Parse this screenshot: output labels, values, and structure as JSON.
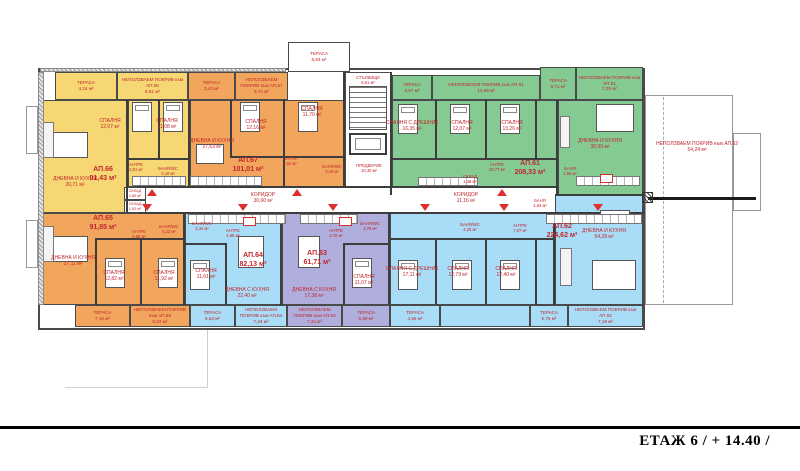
{
  "meta": {
    "floor_label": "ЕТАЖ 6 / + 14.40 /"
  },
  "palette": {
    "yellow": "#f6d774",
    "orange": "#f2a55c",
    "green": "#85ca92",
    "blue": "#a9dcf6",
    "lavender": "#afaedc",
    "white": "#ffffff",
    "wall": "#3d3d3d",
    "label_red": "#c1272d",
    "arrow_red": "#e02f2f"
  },
  "zones": [
    {
      "id": "terrace-ap66",
      "x": 55,
      "y": 72,
      "w": 62,
      "h": 28,
      "fill": "yellow",
      "label": "ТЕРАСА",
      "area": "4,24 м²"
    },
    {
      "id": "roof-ap66",
      "x": 117,
      "y": 72,
      "w": 71,
      "h": 28,
      "fill": "yellow",
      "label": "НЕПОЛЗВАЕМ ПОКРИВ към АП.66",
      "area": "8,91 м²"
    },
    {
      "id": "terrace-ap67",
      "x": 188,
      "y": 72,
      "w": 47,
      "h": 28,
      "fill": "orange",
      "label": "ТЕРАСА",
      "area": "3,43 м²"
    },
    {
      "id": "roof-ap67",
      "x": 235,
      "y": 72,
      "w": 53,
      "h": 28,
      "fill": "orange",
      "label": "НЕПОЛЗВАЕМ ПОКРИВ към АП.67",
      "area": "3,74 м²"
    },
    {
      "id": "terrace-stair",
      "x": 288,
      "y": 42,
      "w": 62,
      "h": 30,
      "fill": "white",
      "label": "ТЕРАСА",
      "area": "8,83 м²"
    },
    {
      "id": "terrace-ap61-left",
      "x": 392,
      "y": 75,
      "w": 40,
      "h": 25,
      "fill": "green",
      "label": "ТЕРАСА",
      "area": "3,07 м²"
    },
    {
      "id": "roof-ap61",
      "x": 432,
      "y": 75,
      "w": 108,
      "h": 25,
      "fill": "green",
      "label": "НЕПОЛЗВАЕМ ПОКРИВ към АП.61",
      "area": "14,68 м²"
    },
    {
      "id": "terrace-ap61-right",
      "x": 540,
      "y": 67,
      "w": 36,
      "h": 33,
      "fill": "green",
      "label": "ТЕРАСА",
      "area": "5,71 м²"
    },
    {
      "id": "roof-ap61-right",
      "x": 576,
      "y": 67,
      "w": 67,
      "h": 33,
      "fill": "green",
      "label": "НЕПОЛЗВАЕМ ПОКРИВ към АП.61",
      "area": "7,39 м²"
    },
    {
      "id": "ap66-main",
      "x": 40,
      "y": 100,
      "w": 88,
      "h": 113,
      "fill": "yellow"
    },
    {
      "id": "ap66-bedrooms",
      "x": 128,
      "y": 100,
      "w": 62,
      "h": 87,
      "fill": "yellow"
    },
    {
      "id": "ap67",
      "x": 190,
      "y": 100,
      "w": 155,
      "h": 87,
      "fill": "orange"
    },
    {
      "id": "stairwell",
      "x": 345,
      "y": 72,
      "w": 47,
      "h": 115,
      "fill": "white"
    },
    {
      "id": "ap61-main",
      "x": 392,
      "y": 100,
      "w": 166,
      "h": 87,
      "fill": "green"
    },
    {
      "id": "ap61-living",
      "x": 558,
      "y": 100,
      "w": 85,
      "h": 95,
      "fill": "green"
    },
    {
      "id": "corridor",
      "x": 138,
      "y": 187,
      "w": 420,
      "h": 26,
      "fill": "white"
    },
    {
      "id": "skl-1",
      "x": 124,
      "y": 187,
      "w": 22,
      "h": 13,
      "fill": "white",
      "label": "СКЛАД",
      "area": "1,80 м²",
      "tiny": true
    },
    {
      "id": "skl-2",
      "x": 124,
      "y": 200,
      "w": 22,
      "h": 13,
      "fill": "white",
      "label": "СКЛАД",
      "area": "1,52 м²",
      "tiny": true
    },
    {
      "id": "ap65",
      "x": 40,
      "y": 213,
      "w": 145,
      "h": 92,
      "fill": "orange"
    },
    {
      "id": "ap64",
      "x": 185,
      "y": 213,
      "w": 97,
      "h": 92,
      "fill": "blue"
    },
    {
      "id": "ap63",
      "x": 282,
      "y": 213,
      "w": 108,
      "h": 92,
      "fill": "lavender"
    },
    {
      "id": "ap62-bedrooms",
      "x": 390,
      "y": 213,
      "w": 165,
      "h": 92,
      "fill": "blue"
    },
    {
      "id": "ap62-living",
      "x": 555,
      "y": 195,
      "w": 88,
      "h": 110,
      "fill": "blue"
    },
    {
      "id": "strip-terrace-ap65",
      "x": 75,
      "y": 305,
      "w": 55,
      "h": 22,
      "fill": "orange",
      "label": "ТЕРАСА",
      "area": "7,16 м²"
    },
    {
      "id": "strip-roof-ap65",
      "x": 130,
      "y": 305,
      "w": 60,
      "h": 22,
      "fill": "orange",
      "label": "НЕПОЛЗВАЕМ ПОКРИВ към АП.65",
      "area": "5,63 м²"
    },
    {
      "id": "strip-terrace-ap64",
      "x": 190,
      "y": 305,
      "w": 45,
      "h": 22,
      "fill": "blue",
      "label": "ТЕРАСА",
      "area": "5,63 м²"
    },
    {
      "id": "strip-roof-ap64",
      "x": 235,
      "y": 305,
      "w": 52,
      "h": 22,
      "fill": "blue",
      "label": "НЕПОЛЗВАЕМ ПОКРИВ към АП.64",
      "area": "7,34 м²"
    },
    {
      "id": "strip-roof-ap63",
      "x": 287,
      "y": 305,
      "w": 55,
      "h": 22,
      "fill": "lavender",
      "label": "НЕПОЛЗВАЕМ ПОКРИВ към АП.63",
      "area": "7,34 м²"
    },
    {
      "id": "strip-terrace-ap63",
      "x": 342,
      "y": 305,
      "w": 48,
      "h": 22,
      "fill": "lavender",
      "label": "ТЕРАСА",
      "area": "5,90 м²"
    },
    {
      "id": "strip-terrace-ap62a",
      "x": 390,
      "y": 305,
      "w": 50,
      "h": 22,
      "fill": "blue",
      "label": "ТЕРАСА",
      "area": "4,56 м²"
    },
    {
      "id": "strip-ap62-plain",
      "x": 440,
      "y": 305,
      "w": 90,
      "h": 22,
      "fill": "blue"
    },
    {
      "id": "strip-terrace-ap62b",
      "x": 530,
      "y": 305,
      "w": 38,
      "h": 22,
      "fill": "blue",
      "label": "ТЕРАСА",
      "area": "5,75 м²"
    },
    {
      "id": "strip-roof-ap62",
      "x": 568,
      "y": 305,
      "w": 75,
      "h": 22,
      "fill": "blue",
      "label": "НЕПОЛЗВАЕМ ПОКРИВ към АП.62",
      "area": "7,19 м²"
    }
  ],
  "apartments": [
    {
      "label": "АП.66",
      "area": "91,43 м²",
      "x": 103,
      "y": 166
    },
    {
      "label": "АП.65",
      "area": "91,85 м²",
      "x": 103,
      "y": 215
    },
    {
      "label": "АП.67",
      "area": "101,01 м²",
      "x": 248,
      "y": 157
    },
    {
      "label": "АП.61",
      "area": "208,33 м²",
      "x": 530,
      "y": 160
    },
    {
      "label": "АП.62",
      "area": "224,62 м²",
      "x": 562,
      "y": 223
    },
    {
      "label": "АП.64",
      "area": "82,13 м²",
      "x": 253,
      "y": 252
    },
    {
      "label": "АП.63",
      "area": "61,71 м²",
      "x": 317,
      "y": 250
    }
  ],
  "rooms": [
    {
      "n": "СПАЛНЯ",
      "a": "12,07 м²",
      "x": 110,
      "y": 118
    },
    {
      "n": "СПАЛНЯ",
      "a": "11,08 м²",
      "x": 167,
      "y": 118
    },
    {
      "n": "ДНЕВНА И КУХНЯ",
      "a": "20,71 м²",
      "x": 75,
      "y": 176
    },
    {
      "n": "АНТРЕ",
      "a": "3,81 м²",
      "x": 136,
      "y": 162,
      "tiny": true
    },
    {
      "n": "БАНЯ/WC",
      "a": "2,18 м²",
      "x": 168,
      "y": 166,
      "tiny": true
    },
    {
      "n": "ДНЕВНА И КУХНЯ",
      "a": "27,63 м²",
      "x": 212,
      "y": 138
    },
    {
      "n": "СПАЛНЯ",
      "a": "12,16 м²",
      "x": 256,
      "y": 119
    },
    {
      "n": "СПАЛНЯ",
      "a": "11,70 м²",
      "x": 312,
      "y": 106
    },
    {
      "n": "АНТРЕ",
      "a": "3,62 м²",
      "x": 290,
      "y": 156,
      "tiny": true
    },
    {
      "n": "БАНЯ/WC",
      "a": "2,19 м²",
      "x": 332,
      "y": 164,
      "tiny": true
    },
    {
      "n": "СТЪЛБИЩЕ",
      "a": "8,61 м²",
      "x": 368,
      "y": 75,
      "tiny": true
    },
    {
      "n": "ПРЕДВЕРИЕ",
      "a": "10,30 м²",
      "x": 369,
      "y": 163,
      "tiny": true
    },
    {
      "n": "КОРИДОР",
      "a": "30,60 м²",
      "x": 263,
      "y": 192
    },
    {
      "n": "КОРИДОР",
      "a": "11,16 м²",
      "x": 466,
      "y": 192
    },
    {
      "n": "СПАЛНЯ С ДРЕШНИК",
      "a": "16,35 м²",
      "x": 412,
      "y": 120
    },
    {
      "n": "СПАЛНЯ",
      "a": "12,07 м²",
      "x": 462,
      "y": 120
    },
    {
      "n": "СПАЛНЯ",
      "a": "13,26 м²",
      "x": 512,
      "y": 120
    },
    {
      "n": "ДНЕВНА И КУХНЯ",
      "a": "30,90 м²",
      "x": 600,
      "y": 138
    },
    {
      "n": "АНТРЕ",
      "a": "20,77 м²",
      "x": 497,
      "y": 162,
      "tiny": true
    },
    {
      "n": "СКЛАД",
      "a": "1,48 м²",
      "x": 470,
      "y": 174,
      "tiny": true
    },
    {
      "n": "БАНЯ",
      "a": "4,50 м²",
      "x": 570,
      "y": 166,
      "tiny": true
    },
    {
      "n": "БАНЯ",
      "a": "4,63 м²",
      "x": 540,
      "y": 198,
      "tiny": true
    },
    {
      "n": "СПАЛНЯ С ДРЕШНИК",
      "a": "17,11 м²",
      "x": 412,
      "y": 266
    },
    {
      "n": "СПАЛНЯ",
      "a": "12,79 м²",
      "x": 458,
      "y": 266
    },
    {
      "n": "СПАЛНЯ",
      "a": "12,40 м²",
      "x": 506,
      "y": 266
    },
    {
      "n": "АНТРЕ",
      "a": "7,07 м²",
      "x": 520,
      "y": 223,
      "tiny": true
    },
    {
      "n": "БАНЯ/WC",
      "a": "4,20 м²",
      "x": 470,
      "y": 222,
      "tiny": true
    },
    {
      "n": "ДНЕВНА И КУХНЯ",
      "a": "54,28 м²",
      "x": 604,
      "y": 228
    },
    {
      "n": "БАНЯ/WC",
      "a": "3,34 м²",
      "x": 202,
      "y": 221,
      "tiny": true
    },
    {
      "n": "АНТРЕ",
      "a": "4,95 м²",
      "x": 233,
      "y": 228,
      "tiny": true
    },
    {
      "n": "СПАЛНЯ",
      "a": "11,61 м²",
      "x": 206,
      "y": 268
    },
    {
      "n": "ДНЕВНА С КУХНЯ",
      "a": "22,40 м²",
      "x": 247,
      "y": 287
    },
    {
      "n": "БАНЯ/WC",
      "a": "3,79 м²",
      "x": 370,
      "y": 221,
      "tiny": true
    },
    {
      "n": "АНТРЕ",
      "a": "3,78 м²",
      "x": 336,
      "y": 228,
      "tiny": true
    },
    {
      "n": "СПАЛНЯ",
      "a": "11,07 м²",
      "x": 364,
      "y": 274
    },
    {
      "n": "ДНЕВНА С КУХНЯ",
      "a": "17,38 м²",
      "x": 314,
      "y": 287
    },
    {
      "n": "ДНЕВНА И КУХНЯ",
      "a": "27,11 м²",
      "x": 73,
      "y": 255
    },
    {
      "n": "АНТРЕ",
      "a": "5,85 м²",
      "x": 139,
      "y": 229,
      "tiny": true
    },
    {
      "n": "БАНЯ/WC",
      "a": "5,23 м²",
      "x": 169,
      "y": 224,
      "tiny": true
    },
    {
      "n": "СПАЛНЯ",
      "a": "12,82 м²",
      "x": 114,
      "y": 270
    },
    {
      "n": "СПАЛНЯ",
      "a": "11,92 м²",
      "x": 164,
      "y": 270
    }
  ],
  "annex": {
    "label": "НЕПОЛЗВАЕМ ПОКРИВ към АП.62",
    "area": "54,24 м²",
    "x": 697,
    "y": 141,
    "rects": [
      [
        645,
        95,
        88,
        210
      ],
      [
        733,
        133,
        28,
        78
      ]
    ],
    "dash": [
      663,
      97,
      206
    ],
    "cut": [
      648,
      197,
      108
    ],
    "hatchbox": [
      642,
      192,
      11,
      11
    ]
  },
  "walls": [
    [
      126,
      100,
      2,
      113
    ],
    [
      188,
      100,
      2,
      87
    ],
    [
      158,
      100,
      2,
      58
    ],
    [
      128,
      158,
      62,
      2
    ],
    [
      230,
      100,
      2,
      58
    ],
    [
      283,
      100,
      2,
      87
    ],
    [
      230,
      156,
      113,
      2
    ],
    [
      343,
      72,
      2,
      115
    ],
    [
      390,
      72,
      2,
      123
    ],
    [
      435,
      100,
      2,
      60
    ],
    [
      485,
      100,
      2,
      60
    ],
    [
      535,
      100,
      2,
      60
    ],
    [
      556,
      100,
      2,
      95
    ],
    [
      392,
      158,
      164,
      2
    ],
    [
      138,
      186,
      420,
      2
    ],
    [
      138,
      212,
      507,
      2
    ],
    [
      555,
      194,
      90,
      2
    ],
    [
      183,
      213,
      2,
      92
    ],
    [
      280,
      213,
      2,
      92
    ],
    [
      388,
      213,
      2,
      92
    ],
    [
      553,
      213,
      2,
      92
    ],
    [
      95,
      240,
      2,
      65
    ],
    [
      140,
      240,
      2,
      65
    ],
    [
      95,
      238,
      90,
      2
    ],
    [
      225,
      245,
      2,
      60
    ],
    [
      185,
      243,
      42,
      2
    ],
    [
      343,
      245,
      2,
      60
    ],
    [
      343,
      243,
      47,
      2
    ],
    [
      435,
      240,
      2,
      65
    ],
    [
      485,
      240,
      2,
      65
    ],
    [
      535,
      240,
      2,
      65
    ],
    [
      390,
      238,
      165,
      2
    ]
  ],
  "markers": {
    "up_x": [
      147,
      292,
      497
    ],
    "up_y": 189,
    "down_x": [
      142,
      238,
      328,
      420,
      499,
      593
    ],
    "down_y": 204
  },
  "badges": [
    [
      243,
      217,
      13,
      9
    ],
    [
      339,
      217,
      13,
      9
    ],
    [
      600,
      174,
      13,
      9
    ]
  ],
  "furniture": {
    "beds": [
      [
        132,
        102
      ],
      [
        163,
        102
      ],
      [
        240,
        102
      ],
      [
        298,
        102
      ],
      [
        398,
        104
      ],
      [
        450,
        104
      ],
      [
        500,
        104
      ],
      [
        105,
        258
      ],
      [
        158,
        258
      ],
      [
        190,
        260
      ],
      [
        352,
        258
      ],
      [
        398,
        260
      ],
      [
        452,
        260
      ],
      [
        500,
        260
      ]
    ],
    "tables": [
      [
        52,
        132,
        36,
        26
      ],
      [
        50,
        236,
        38,
        26
      ],
      [
        196,
        144,
        28,
        20
      ],
      [
        596,
        104,
        38,
        28
      ],
      [
        592,
        260,
        44,
        30
      ],
      [
        238,
        236,
        26,
        32
      ],
      [
        298,
        236,
        22,
        32
      ],
      [
        600,
        210,
        30,
        14
      ]
    ],
    "sofas": [
      [
        42,
        122,
        12,
        36
      ],
      [
        42,
        226,
        12,
        36
      ],
      [
        560,
        116,
        10,
        32
      ],
      [
        560,
        248,
        12,
        38
      ]
    ],
    "counters": [
      [
        132,
        176,
        54,
        10
      ],
      [
        190,
        176,
        72,
        10
      ],
      [
        418,
        177,
        60,
        9
      ],
      [
        576,
        176,
        64,
        10
      ],
      [
        188,
        214,
        98,
        10
      ],
      [
        300,
        214,
        58,
        10
      ],
      [
        546,
        214,
        96,
        10
      ]
    ]
  },
  "extras": {
    "balconies": [
      [
        26,
        106,
        12,
        48
      ],
      [
        26,
        220,
        12,
        48
      ]
    ],
    "hatches": [
      [
        38,
        72,
        6,
        233
      ],
      [
        40,
        68,
        246,
        4
      ]
    ],
    "ghosts": [
      [
        65,
        387,
        143,
        1
      ],
      [
        207,
        330,
        1,
        58
      ]
    ]
  },
  "stair_parts": {
    "treads": [
      349,
      86,
      38,
      44
    ],
    "elevator": [
      349,
      133,
      38,
      22
    ]
  }
}
